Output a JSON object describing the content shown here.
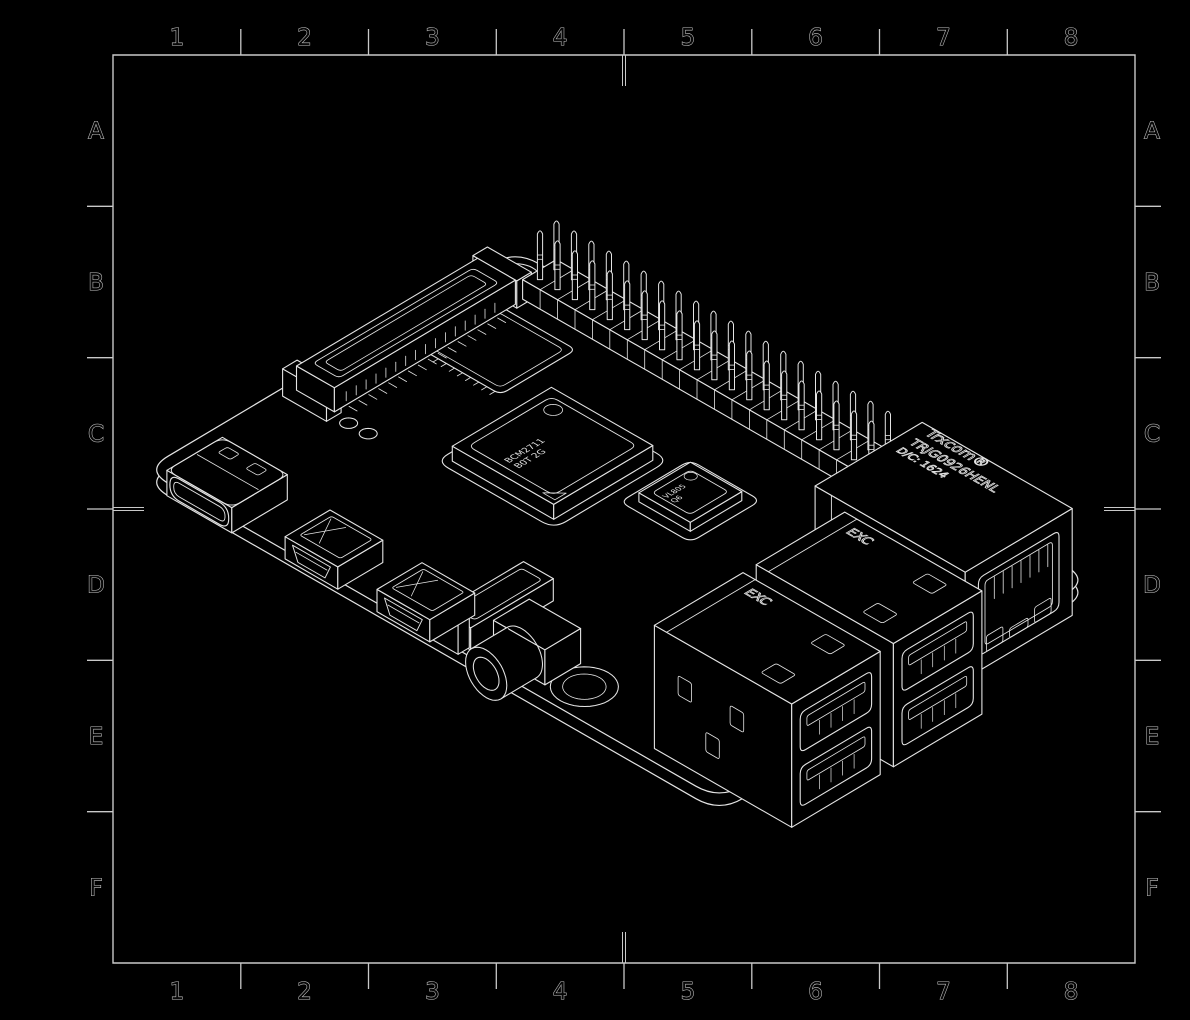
{
  "frame": {
    "columns": [
      "1",
      "2",
      "3",
      "4",
      "5",
      "6",
      "7",
      "8"
    ],
    "rows": [
      "A",
      "B",
      "C",
      "D",
      "E",
      "F"
    ]
  },
  "board": {
    "soc_marking": [
      "BCM2711",
      "B0T 2G"
    ],
    "usb_controller_marking": [
      "VL805",
      "Q6"
    ],
    "usb_stack_marking": "EXC",
    "ethernet_marking": [
      "Trxcom®",
      "TRJG0926HENL",
      "D/C: 1624"
    ],
    "silkscreen_registered_mark": "®"
  },
  "colors": {
    "background": "#000000",
    "line": "#e4e4e4",
    "frame_line": "#c9c9c9",
    "label_fill": "#070707"
  }
}
